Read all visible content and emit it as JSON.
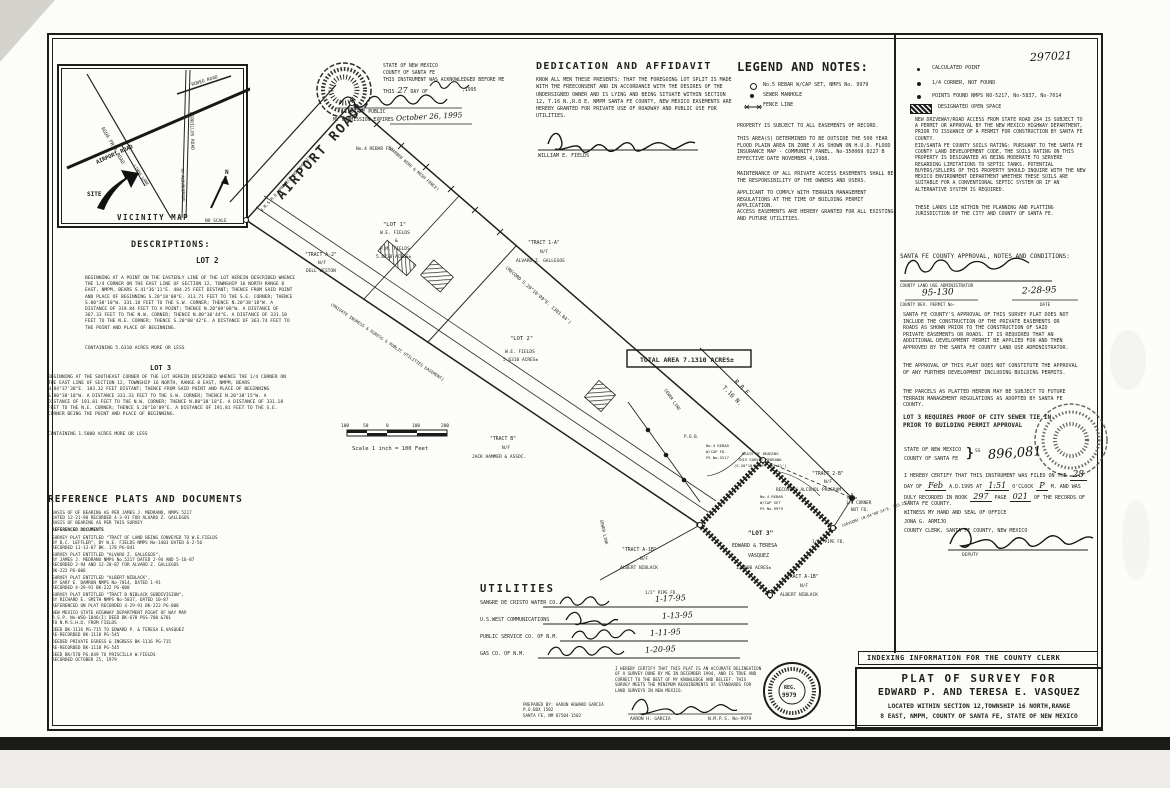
{
  "scan": {
    "doc_number_stamp": "297021"
  },
  "vicinity": {
    "title": "VICINITY MAP",
    "no_scale": "NO SCALE",
    "site": "SITE",
    "north": "N",
    "roads": {
      "agua_fria": "AGUA FRIA ROAD",
      "airport": "AIRPORT ROAD",
      "cerrillos": "CERRILLOS ROAD",
      "rodeo": "RODEO ROAD",
      "linda_lane": "LINDA LANE",
      "to_albuquerque": "TO ALBUQUERQUE"
    }
  },
  "notary": {
    "state": "STATE OF NEW MEXICO",
    "county": "COUNTY OF SANTA FE",
    "ack": "THIS INSTRUMENT WAS ACKNOWLEDGED BEFORE ME",
    "this_label": "THIS",
    "day": "27",
    "day_of": "DAY OF",
    "year": ",1995",
    "notary_public": "NOTARY PUBLIC",
    "expires_label": "MY COMMISSION EXPIRES",
    "expires_date": "October 26, 1995"
  },
  "dedication": {
    "heading": "DEDICATION AND AFFIDAVIT",
    "body": "KNOW ALL MEN THESE PRESENTS: THAT THE FOREGOING LOT SPLIT IS MADE WITH THE FREECONSENT AND IN ACCORDANCE WITH THE DESIRES OF THE UNDERSIGNED OWNER AND IS LYING AND BEING SITUATE WITHIN SECTION 12, T.16 N.,R.8 E. NMPM SANTA FE COUNTY, NEW MEXICO EASEMENTS ARE HEREBY GRANTED FOR PRIVATE USE OF ROADWAY AND PUBLIC USE FOR UTILITIES.",
    "signer": "WILLIAM E. FIELDS"
  },
  "legend": {
    "heading": "LEGEND AND NOTES:",
    "items": [
      {
        "label": "No.5 REBAR W/CAP SET, NMPS No. 9979"
      },
      {
        "label": "SEWER MANHOLE"
      },
      {
        "label": "FENCE LINE"
      }
    ],
    "notes": [
      "PROPERTY IS SUBJECT TO ALL EASEMENTS OF RECORD.",
      "THIS AREA(S) DETERMINED TO BE OUTSIDE THE 500 YEAR FLOOD PLAIN AREA IN ZONE X AS SHOWN ON H.U.D. FLOOD INSURANCE MAP - COMMUNITY PANEL, No-350069 0227 B EFFECTIVE DATE NOVEMBER 4,1988.",
      "MAINTENANCE OF ALL PRIVATE ACCESS EASEMENTS SHALL BE THE RESPONSIBILITY OF THE OWNERS AND USERS.",
      "APPLICANT TO COMPLY WITH TERRAIN MANAGEMENT REGULATIONS AT THE TIME OF BUILDING PERMIT APPLICATION.",
      "ACCESS EASEMENTS ARE HEREBY GRANTED FOR ALL EXISTING AND FUTURE UTILITIES."
    ]
  },
  "legend_right": {
    "items": [
      "CALCULATED POINT",
      "1/4 CORNER, NOT FOUND",
      "POINTS FOUND NMPS NO-5217,  No-5837,  No-7014",
      "DESIGNATED OPEN SPACE"
    ],
    "notes": [
      "NEW DRIVEWAY/ROAD ACCESS FROM STATE ROAD 284 IS SUBJECT TO A PERMIT OR APPROVAL BY THE NEW MEXICO HIGHWAY DEPARTMENT, PRIOR TO ISSUANCE OF A PERMIT FOR CONSTRUCTION BY SANTA FE COUNTY.",
      "EID/SANTA FE COUNTY SOILS RATING: PURSUANT TO THE SANTA FE COUNTY LAND DEVELOPEMENT CODE, THE SOILS RATING ON THIS PROPERTY IS DESIGNATED AS BEING MODERATE TO SERVERE REGARDING LIMITATIONS TO SEPTIC TANKS. POTENTIAL BUYERS/SELLERS OF THIS PROPERTY SHOULD INQUIRE WITH THE NEW MEXICO ENVIRONMENT DEPARTMENT WHETHER THESE SOILS ARE SUITABLE FOR A CONVENTIONAL SEPTIC SYSTEM OR IF AN ALTERNATIVE SYSTEM IS REQUIRED.",
      "THESE LANDS LIE WITHIN THE PLANNING AND PLATTING JURISDICTION OF THE CITY AND COUNTY OF SANTA FE."
    ]
  },
  "approval": {
    "heading": "SANTA FE COUNTY APPROVAL, NOTES AND CONDITIONS:",
    "admin_label": "COUNTY LAND USE ADMINISTRATOR",
    "permit_no": "95-130",
    "permit_label": "COUNTY DEV. PERMIT No-",
    "date": "2-28-95",
    "date_label": "DATE",
    "paras": [
      "SANTA FE COUNTY'S APPROVAL OF THIS SURVEY PLAT DOES NOT INCLUDE THE CONSTRUCTION OF THE PRIVATE EASEMENTS OR ROADS AS SHOWN PRIOR TO THE CONSTRUCTION OF SAID PRIVATE EASEMENTS OR ROADS. IT IS REQUIRED THAT AN ADDITIONAL DEVELOPMENT PERMIT BE APPLIED FOR AND THEN APPROVED BY THE SANTA FE COUNTY LAND USE ADMINISTRATOR.",
      "THE APPROVAL OF THIS PLAT DOES NOT CONSTITUTE THE APPROVAL OF ANY FURTHER DEVELOPMENT INCLUDING BUILDING PERMITS.",
      "THE PARCELS AS PLATTED HEREON MAY BE SUBJECT TO FUTURE TERRAIN MANAGEMENT REGULATIONS AS ADOPTED BY SANTA FE COUNTY."
    ],
    "lot3_note": "LOT 3 REQUIRES PROOF OF CITY SEWER TIE IN\nPRIOR TO BUILDING PERMIT APPROVAL"
  },
  "recording": {
    "state": "STATE OF NEW MEXICO",
    "county": "COUNTY OF SANTA FE",
    "ss": "SS",
    "doc_number": "896,081",
    "cert_pre": "I HEREBY CERTIFY THAT THIS INSTRUMENT WAS FILED ON THE",
    "day": "28",
    "l2a": "DAY OF",
    "month": "Feb",
    "l2b": "A.D.1995 AT",
    "time": "1:51",
    "l2c": "O'CLOCK",
    "ampm": "P",
    "l2d": "M. AND WAS",
    "l3a": "DULY RECORDED IN BOOK",
    "book": "297",
    "l3b": "PAGE",
    "page": "021",
    "l3c": "OF THE RECORDS OF",
    "l4": "SANTA FE COUNTY.",
    "witness": "WITNESS MY HAND AND SEAL OF OFFICE",
    "clerk_name": "JONA G. ARMIJO",
    "clerk_title": "COUNTY CLERK, SANTA FE COUNTY, NEW MEXICO",
    "deputy": "DEPUTY"
  },
  "descriptions": {
    "heading": "DESCRIPTIONS:",
    "lot2": {
      "title": "LOT 2",
      "body": "BEGINNING AT A POINT ON THE EASTERLY LINE OF THE LOT HEREIN DESCRIBED WHENCE THE 1/4 CORNER ON THE EAST LINE OF SECTION 12, TOWNSHIP 16 NORTH RANGE 8 EAST, NMPM, BEARS S.41°36'11\"E. 484.25 FEET DISTANT; THENCE FROM SAID POINT AND PLACE OF BEGINNING S.20°18'08\"E. 313.71 FEET TO THE S.E. CORNER; THENCE S.80°38'18\"W. 331.18 FEET TO THE S.W. CORNER; THENCE N.20°38'18\"W. A DISTANCE OF 319.84 FEET TO A POINT; THENCE N.20°09'08\"W. A DISTANCE OF 367.33 FEET TO THE N.W. CORNER; THENCE N.80°30'44\"E. A DISTANCE OF 331.18 FEET TO THE N.E. CORNER; THENCE S.20°08'42\"E. A DISTANCE OF 363.74 FEET TO THE POINT AND PLACE OF BEGINNING.",
      "containing": "CONTAINING 5.6310 ACRES MORE OR LESS"
    },
    "lot3": {
      "title": "LOT 3",
      "body": "BEGINNING AT THE SOUTHEAST CORNER OF THE LOT HEREIN DESCRIBED WHENCE THE 1/4 CORNER ON THE EAST LINE OF SECTION 12, TOWNSHIP 16 NORTH, RANGE 8 EAST, NMPM, BEARS N.84°37'38\"E. 183.32 FEET DISTANT; THENCE FROM SAID POINT AND PLACE OF BEGINNING S.80°38'18\"W. A DISTANCE 331.33 FEET TO THE S.W. CORNER; THENCE N.20°38'15\"W. A DISTANCE OF 191.81 FEET TO THE N.W. CORNER; THENCE N.80°38'18\"E. A DISTANCE OF 331.18 FEET TO THE N.E. CORNER; THENCE S.20°10'09\"E. A DISTANCE OF 191.81 FEET TO THE S.E. CORNER BEING THE POINT AND PLACE OF BEGINNING.",
      "containing": "CONTAINING 1.5000 ACRES MORE OR LESS"
    }
  },
  "references": {
    "heading": "REFERENCE PLATS AND DOCUMENTS",
    "items": [
      "BASIS OF OF BEARING AS PER JAMES J. MEDRANO, NMPS 5217\nDATED 12-21-90 RECORDED 4-3-91 FOR ALVARO Z. GALLEGOS\nBASIS OF BEARING AS PER THIS SURVEY",
      "REFERENCED DOCUMENTS",
      "SURVEY PLAT ENTITLED \"TRACT OF LAND BEING CONVEYED TO W.E.FIELDS\nBY B.C. LEFFLER\", BY W.E. FIELDS NMPS No-1403  DATED 6-2-56\nRECORDED 11-13-87  BK. 178 PG-041",
      "SURVEY PLAT ENTITLED \"ALVARO Z. GALLEGOS\",\nBY JAMES J. MEDRANO NMPS No.5217  DATED 2-94 AND 5-16-87\nRECORDED 2-94 AND 12-28-87 FOR ALVARO Z. GALLEGOS\nBK-222 PG-006",
      "SURVEY PLAT ENTITLED \"ALBERT NIBLACK\",\nBY GARY E. DAMRON NMPS No-7014, DATED 1-91\nRECORDED 4-29-91 BK-222 PG-008",
      "SURVEY PLAT ENTITLED \"TRACT B NIBLACK SUBDIVISION\",\nBY RICHARD E. SMITH NMPS No-5837, DATED 10-87\nREFERENCED ON PLAT RECORDED 4-29-91 BK-222 PG-008",
      "NEW MEXICO STATE HIGHWAY DEPARTMENT RIGHT OF WAY MAP\nR.S.P. No-WSQ-1046(I) DEED BK-678 PGS-700 &701\nTO N.M.S.H.D. FROM FIELDS",
      "DEED BK-1116 PG-715 TO EDWARD P. & TERESA E.VASQUEZ\nRE-RECORDED BK-1118 PG-545",
      "DEEDED PRIVATE EGRESS & INGRESS BK-1116 PG-715\nRE-RECORDED BK-1118 PG-545",
      "DEED BK/570 PG.849 TO PRISCILLA W.FIELDS\nRECORDED OCTOBER 25, 1979"
    ]
  },
  "utilities": {
    "heading": "UTILITIES",
    "rows": [
      {
        "name": "SANGRE DE CRISTO WATER CO.",
        "date": "1-17-95"
      },
      {
        "name": "U.S.WEST COMMUNICATIONS",
        "date": "1-13-95"
      },
      {
        "name": "PUBLIC SERVICE CO. OF N.M.",
        "date": "1-11-95"
      },
      {
        "name": "GAS CO. OF N.M.",
        "date": "1-20-95"
      }
    ]
  },
  "surveyor": {
    "prepared_by": "PREPARED BY: AARON HOWARD GARCIA\nP.O.BOX 1502\nSANTA FE, NM 87504-1502",
    "certification": "I HEREBY CERTIFY THAT THIS PLAT IS AN ACCURATE DELINEATION OF A SURVEY DONE BY ME IN DECEMBER 1994, AND IS TRUE AND CORRECT TO THE BEST OF MY KNOWLEDGE AND BELIEF. THIS SURVEY MEETS THE MINIMUM REQUIREMENTS OF STANDARDS FOR LAND SURVEYS IN NEW MEXICO.",
    "name": "AARON H. GARCIA",
    "reg": "N.M.P.S. No-9979",
    "seal_top": "REG.",
    "seal_num": "9979"
  },
  "title_block": {
    "indexing": "INDEXING INFORMATION FOR THE COUNTY CLERK",
    "line1": "PLAT OF SURVEY FOR",
    "line2": "EDWARD P. AND TERESA E. VASQUEZ",
    "line3": "LOCATED WITHIN SECTION 12,TOWNSHIP 16 NORTH,RANGE",
    "line4": "8 EAST, NMPM, COUNTY OF SANTA FE, STATE OF NEW MEXICO"
  },
  "drawing": {
    "airport_road": "AIRPORT ROAD",
    "nmshd": "N.M.S.H.D. PROJECT NO-1046(I)",
    "rebar_fd": "No.4 REBAR FD.",
    "fence_note": "(BARBED WIRE & MESH FENCE)",
    "lot1": {
      "l1": "\"LOT 1\"",
      "l2": "W.E. FIELDS",
      "l3": "&",
      "l4": "P.M. FIELDS",
      "l5": "5.6238 ACRES±"
    },
    "tract_a2": {
      "l1": "\"TRACT A-2\"",
      "l2": "N/F",
      "l3": "DELL WESTON"
    },
    "tract_1a": {
      "l1": "\"TRACT 1-A\"",
      "l2": "N/F",
      "l3": "ALVARO Z. GALLEGOS"
    },
    "record_bearing": "(RECORD S.20°10'09\"E. 1303.84')",
    "easement_note": "(PRIVATE INGRESS & EGRESS & PUBLIC UTILITIES EASEMENT)",
    "lot2": {
      "l1": "\"LOT 2\"",
      "l2": "W.E. FIELDS",
      "l3": "5.6310 ACRES±"
    },
    "total_area": "TOTAL AREA 7.1310 ACRES±",
    "tract_b": {
      "l1": "\"TRACT B\"",
      "l2": "N/F",
      "l3": "JACK HAMMER & ASSOC."
    },
    "scale": {
      "t0": "100",
      "t1": "50",
      "t2": "0",
      "t3": "100",
      "t4": "200",
      "caption": "Scale 1 inch = 100 Feet"
    },
    "section": {
      "l1": "T.16 N.",
      "l2": "R.8 E."
    },
    "sewer": "SEWER LINE",
    "basis": {
      "l1": "BASIS OF BEARING",
      "l2": "THIS SURVEY MEDRANO",
      "l3": "(S.20°18'09\"E. 403.41')"
    },
    "tract_2b": {
      "l1": "\"TRACT 2-B\"",
      "l2": "N/F",
      "l3": "RECOVERY ALCOHOL PROGRAM"
    },
    "rebar_set": {
      "l1": "No.4 REBAR",
      "l2": "W/CAP SET",
      "l3": "PS No-9979"
    },
    "quarter": {
      "l1": "1/4 CORNER",
      "l2": "NOT FD."
    },
    "gavson": "(GAVSON) (N.84°08'34\"E. 183.21')",
    "pipe_fd": "1/2\" PIPE FD.",
    "lot3": {
      "l1": "\"LOT 3\"",
      "l2": "EDWARD & TERESA",
      "l3": "VASQUEZ",
      "l4": "1.5000 ACRES±"
    },
    "tract_a1b": {
      "l1": "\"TRACT A-1B\"",
      "l2": "N/F",
      "l3": "ALBERT NIBLACK"
    },
    "pob": "P.O.B.",
    "rebar_5217": {
      "l1": "No.4 REBAR",
      "l2": "W/CAP FD.",
      "l3": "PS No-5217"
    }
  }
}
